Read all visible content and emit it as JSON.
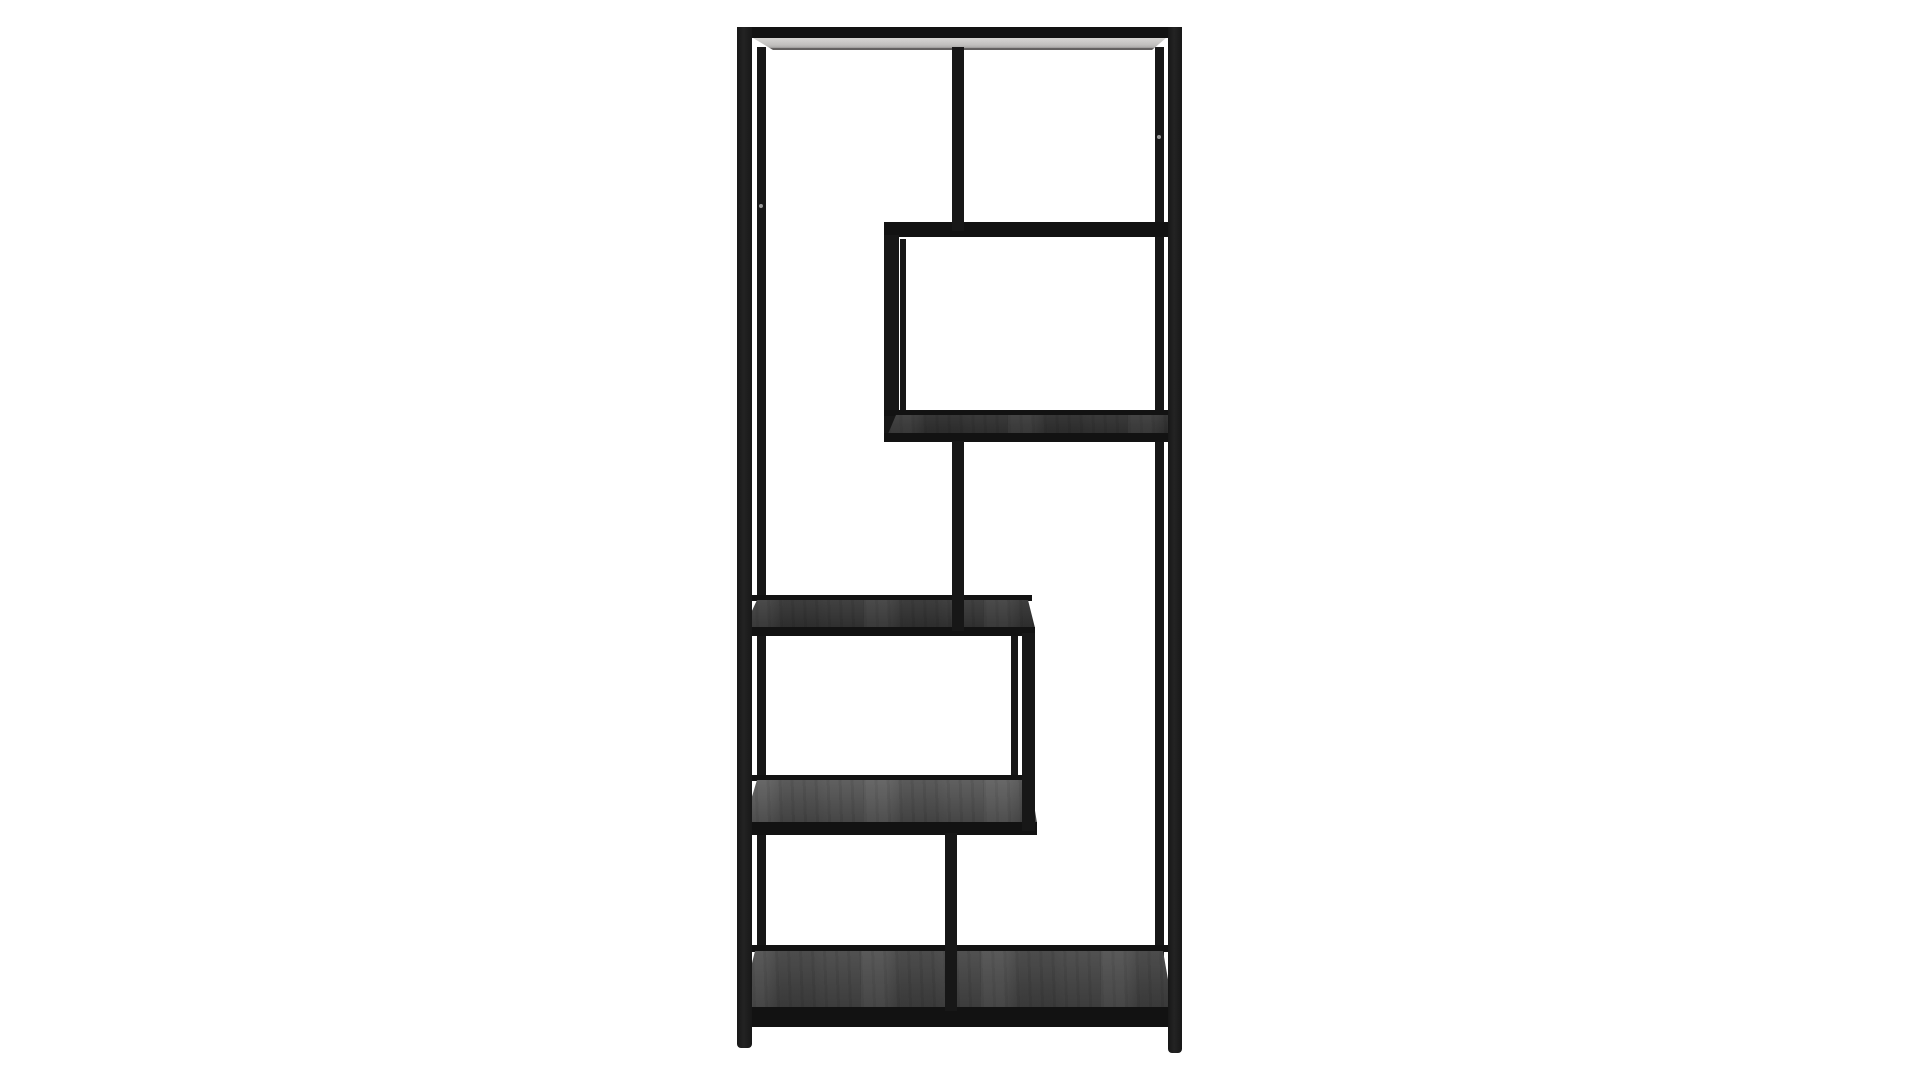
{
  "scene": {
    "type": "studio-product-photo",
    "subject": "Tall black metal etagere bookcase with asymmetric open shelves, front view on a plain white background",
    "furniture_style": "industrial minimalist open shelving unit",
    "visible_text": "",
    "parts": [
      "top-shelf",
      "upper-divider",
      "upper-right-shelf",
      "upper-box-left-panel",
      "middle-right-shelf",
      "middle-divider",
      "center-left-shelf",
      "lower-box-right-panel",
      "lower-left-shelf",
      "lower-divider",
      "bottom-shelf",
      "left-front-leg",
      "left-back-leg",
      "right-front-leg",
      "right-back-leg"
    ]
  },
  "colors": {
    "background": "#ffffff",
    "frame": "#171717",
    "edge": "#121212",
    "top-surface": "#d6d5d3",
    "top-surface-edge": "#514f4e",
    "screw": "#999999",
    "wood3-top": "#3a3a3a",
    "wood3-bottom": "#2d2d2d",
    "wood4-top": "#414141",
    "wood4-bottom": "#2f2f2f",
    "wood5-top": "#606060",
    "wood5-bottom": "#454545",
    "woodb-top": "#515151",
    "woodb-bottom": "#3c3c3c"
  }
}
